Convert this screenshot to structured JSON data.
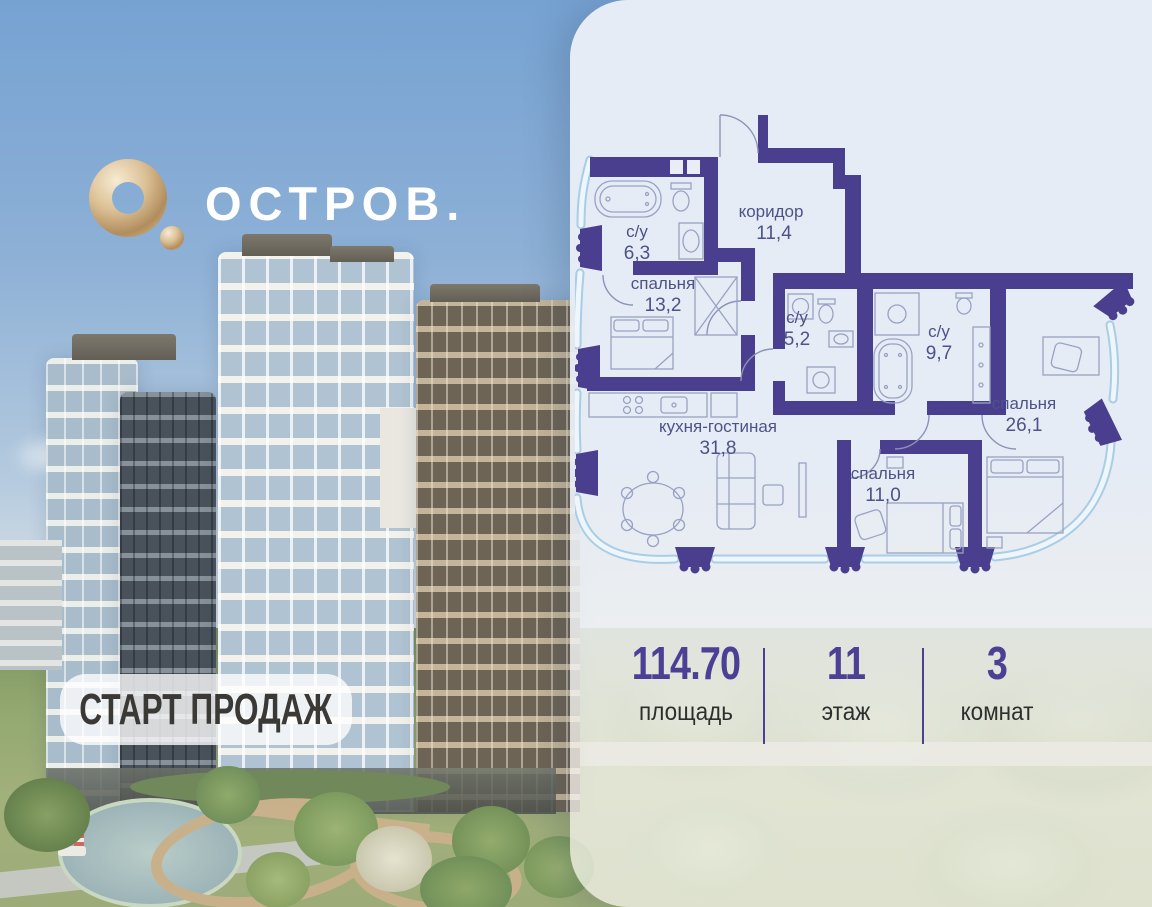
{
  "brand": {
    "title": "ОСТРОВ.",
    "logo_icon": "gold-torus-icon"
  },
  "badge": {
    "label": "СТАРТ ПРОДАЖ"
  },
  "floor_plan": {
    "rooms": [
      {
        "name": "с/у",
        "area": "6,3"
      },
      {
        "name": "коридор",
        "area": "11,4"
      },
      {
        "name": "спальня",
        "area": "13,2"
      },
      {
        "name": "с/у",
        "area": "5,2"
      },
      {
        "name": "с/у",
        "area": "9,7"
      },
      {
        "name": "спальня",
        "area": "26,1"
      },
      {
        "name": "кухня-гостиная",
        "area": "31,8"
      },
      {
        "name": "спальня",
        "area": "11,0"
      }
    ]
  },
  "stats": {
    "items": [
      {
        "value": "114.70",
        "label": "площадь"
      },
      {
        "value": "11",
        "label": "этаж"
      },
      {
        "value": "3",
        "label": "комнат"
      }
    ]
  },
  "colors": {
    "wall_purple": "#4a3e8e",
    "accent_purple": "#4c4095",
    "gold": "#c9a878",
    "glass_blue": "#a9cde5"
  }
}
